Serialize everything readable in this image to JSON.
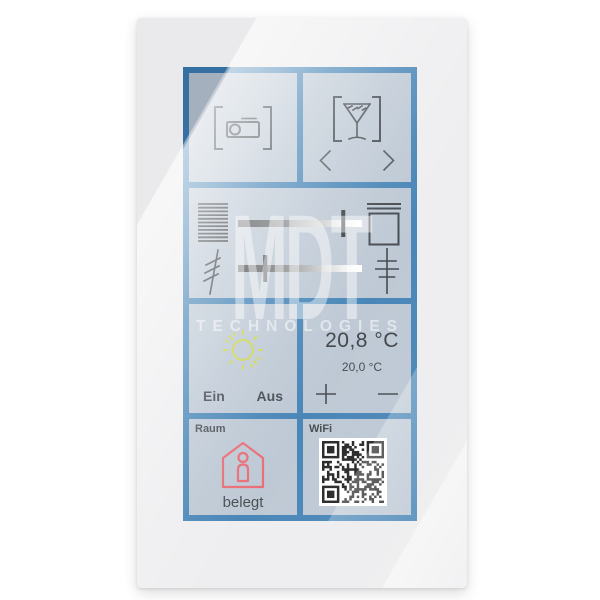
{
  "watermark": {
    "line1": "MDT",
    "line2": "TECHNOLOGIES"
  },
  "colors": {
    "accent_blue": "#3b7db2",
    "tile_background": "#b9c5d2",
    "sun_yellow": "#c9d43c",
    "presence_red": "#e8626c",
    "icon_dark": "#383d44"
  },
  "tiles": {
    "scene_projector": {
      "icon": "projector-in-brackets-icon"
    },
    "scene_cocktail": {
      "icon": "cocktail-in-brackets-icon",
      "prev_icon": "chevron-left-icon",
      "next_icon": "chevron-right-icon"
    },
    "blinds": {
      "left_icon": "blinds-icon",
      "right_icon": "window-icon",
      "position_percent": 85
    },
    "dimmer": {
      "left_icon": "dimmer-icon",
      "right_icon": "dim-levels-icon",
      "position_percent": 22
    },
    "light": {
      "icon": "sun-icon",
      "on_label": "Ein",
      "off_label": "Aus"
    },
    "climate": {
      "current": "20,8 °C",
      "setpoint": "20,0 °C",
      "increase": "+",
      "decrease": "−"
    },
    "presence": {
      "label": "Raum",
      "icon": "house-person-icon",
      "status": "belegt"
    },
    "wifi": {
      "label": "WiFi",
      "content": "qr-code"
    }
  }
}
